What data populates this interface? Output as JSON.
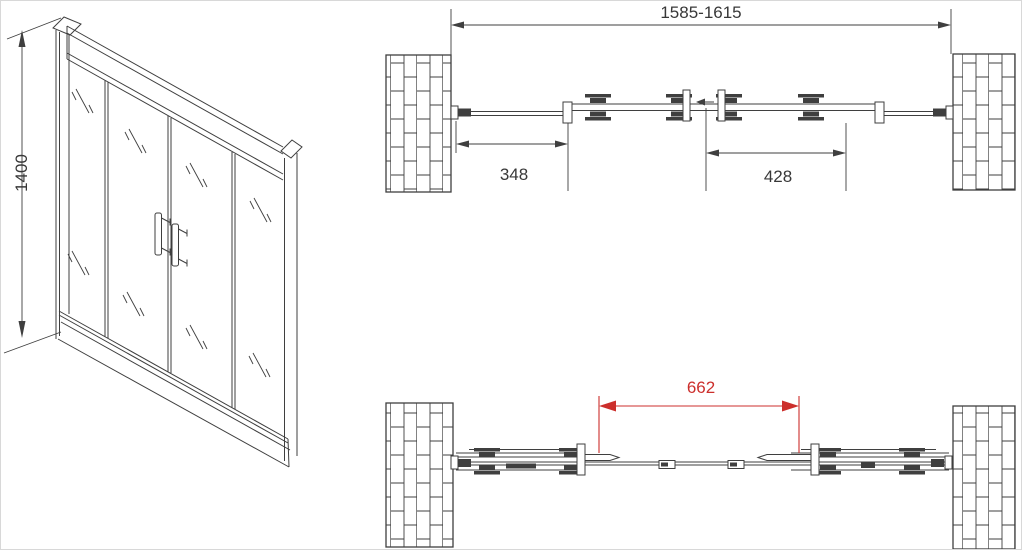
{
  "colors": {
    "line": "#3f3f3f",
    "text": "#383838",
    "dimension_red": "#cc2f2c",
    "background": "#ffffff"
  },
  "views": {
    "elevation": {
      "height_dimension_label": "1400"
    },
    "plan_closed": {
      "overall_width_label": "1585-1615",
      "fixed_panel_width_label": "348",
      "door_panel_width_label": "428"
    },
    "plan_open": {
      "clear_opening_label": "662"
    }
  }
}
